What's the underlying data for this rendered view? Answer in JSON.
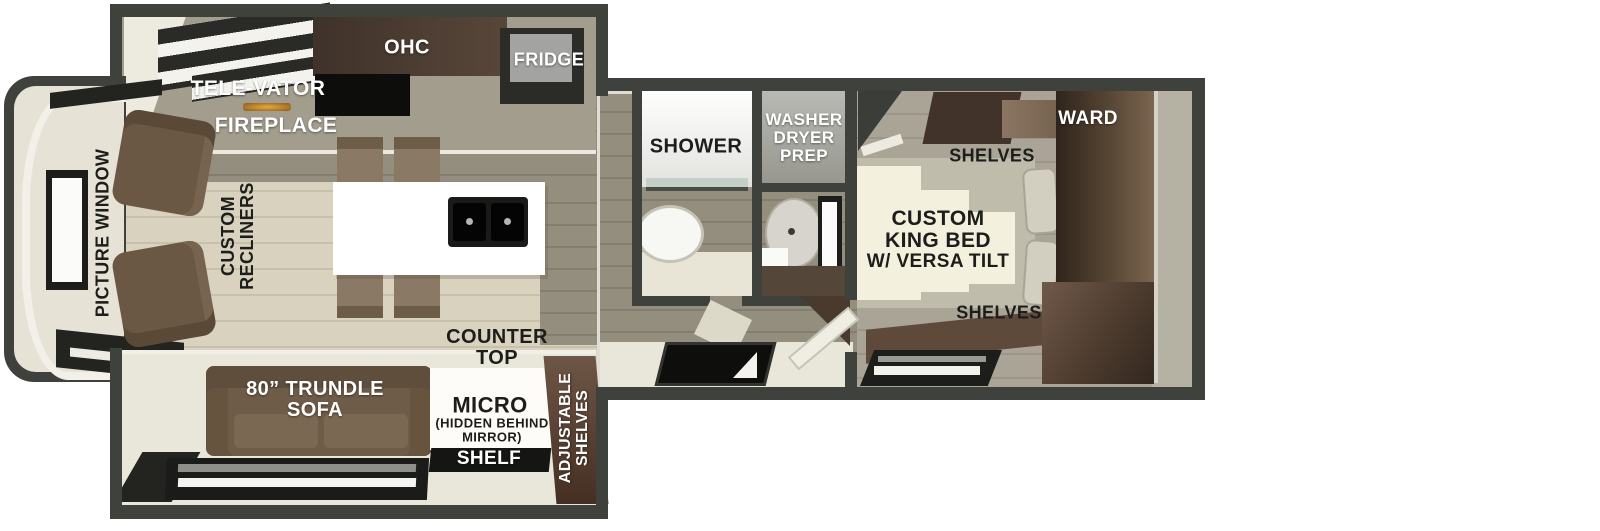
{
  "colors": {
    "wall": "#3f413d",
    "floor_light_plank": "#d8d2bf",
    "floor_olive_plank": "#8f8b7b",
    "slide_floor_cream": "#e9e6da",
    "cabinet_dark_walnut": "#4a3b31",
    "cabinet_brown": "#5d4a3c",
    "sofa_brown": "#6f5d4a",
    "island_white": "#ffffff",
    "fireplace_flame": "#c98a2f",
    "bed_cream": "#f4f0de",
    "bedroom_floor": "#a9a496",
    "window_frame": "#1d1d1b",
    "label_dark": "#1d1d1b",
    "label_light": "#ffffff"
  },
  "rooms": {
    "kitchen": {
      "ohc": "OHC",
      "fridge": "FRIDGE",
      "televator": "TELE-VATOR",
      "fireplace": "FIREPLACE",
      "counter_top": [
        "COUNTER",
        "TOP"
      ]
    },
    "living": {
      "picture_window": "PICTURE WINDOW",
      "recliners": [
        "CUSTOM",
        "RECLINERS"
      ],
      "sofa": [
        "80” TRUNDLE",
        "SOFA"
      ],
      "micro": "MICRO",
      "micro_note": [
        "(HIDDEN BEHIND",
        "MIRROR)"
      ],
      "shelf": "SHELF",
      "adjustable_shelves": [
        "ADJUSTABLE",
        "SHELVES"
      ]
    },
    "bathroom": {
      "shower": "SHOWER",
      "washer_dryer_prep": [
        "WASHER",
        "DRYER",
        "PREP"
      ]
    },
    "bedroom": {
      "ward": "WARD",
      "shelves_top": "SHELVES",
      "king_bed": [
        "CUSTOM",
        "KING BED",
        "W/ VERSA TILT"
      ],
      "shelves_bottom": "SHELVES"
    }
  }
}
